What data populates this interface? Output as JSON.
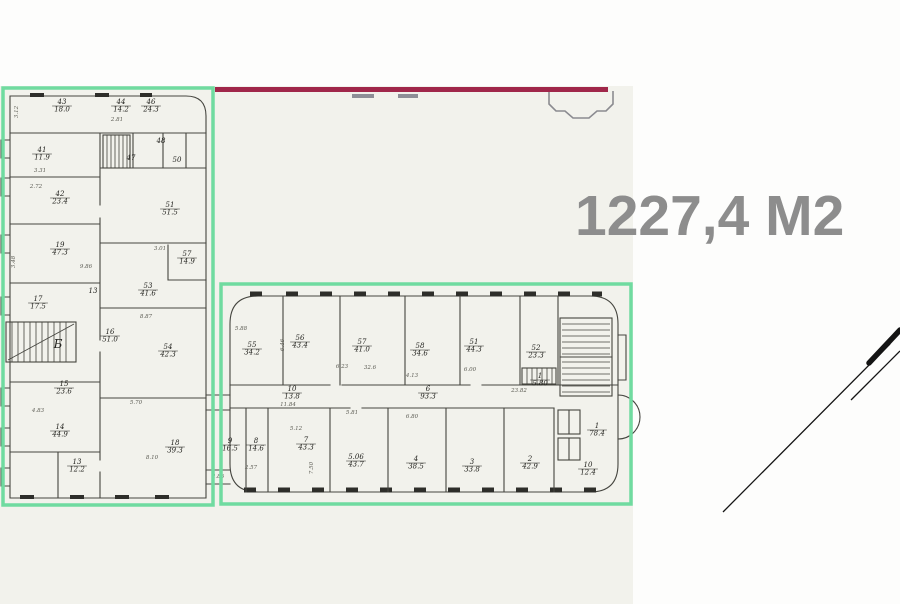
{
  "document": {
    "kind": "scanned floor plan with highlighted zones"
  },
  "area_label": {
    "text": "1227,4 М2"
  },
  "colors": {
    "highlight_green": "#70dba0",
    "line_red": "#a0274a",
    "plan_ink": "#45453f",
    "paper": "#f2f2ec",
    "area_text_gray": "#8d8d8d"
  },
  "plan": {
    "rooms": [
      {
        "num": "43",
        "area": "18.0",
        "x": 62,
        "y": 104
      },
      {
        "num": "44",
        "area": "14.2",
        "x": 121,
        "y": 104
      },
      {
        "num": "46",
        "area": "24.3",
        "x": 151,
        "y": 104
      },
      {
        "num": "48",
        "x": 161,
        "y": 143
      },
      {
        "num": "47",
        "x": 131,
        "y": 160
      },
      {
        "num": "50",
        "x": 177,
        "y": 162
      },
      {
        "num": "41",
        "area": "11.9",
        "x": 42,
        "y": 152
      },
      {
        "num": "42",
        "area": "23.4",
        "x": 60,
        "y": 196
      },
      {
        "num": "51",
        "area": "51.5",
        "x": 170,
        "y": 207
      },
      {
        "num": "19",
        "area": "47.3",
        "x": 60,
        "y": 247
      },
      {
        "num": "57",
        "area": "14.9",
        "x": 187,
        "y": 256
      },
      {
        "num": "53",
        "area": "41.6",
        "x": 148,
        "y": 288
      },
      {
        "num": "13",
        "x": 93,
        "y": 293
      },
      {
        "num": "17",
        "area": "17.5",
        "x": 38,
        "y": 301
      },
      {
        "num": "Б",
        "x": 58,
        "y": 348,
        "big": true
      },
      {
        "num": "16",
        "area": "51.0",
        "x": 110,
        "y": 334
      },
      {
        "num": "15",
        "area": "23.6",
        "x": 64,
        "y": 386
      },
      {
        "num": "54",
        "area": "42.3",
        "x": 168,
        "y": 349
      },
      {
        "num": "14",
        "area": "44.9",
        "x": 60,
        "y": 429
      },
      {
        "num": "18",
        "area": "39.3",
        "x": 175,
        "y": 445
      },
      {
        "num": "13",
        "area": "12.2",
        "x": 77,
        "y": 464
      },
      {
        "num": "55",
        "area": "34.2",
        "x": 252,
        "y": 347
      },
      {
        "num": "56",
        "area": "43.4",
        "x": 300,
        "y": 340
      },
      {
        "num": "57",
        "area": "41.0",
        "x": 362,
        "y": 344
      },
      {
        "num": "58",
        "area": "34.6",
        "x": 420,
        "y": 348
      },
      {
        "num": "51",
        "area": "44.3",
        "x": 474,
        "y": 344
      },
      {
        "num": "52",
        "area": "23.3",
        "x": 536,
        "y": 350
      },
      {
        "num": "1",
        "area": "5.80",
        "x": 540,
        "y": 378
      },
      {
        "num": "6",
        "area": "93.3",
        "x": 428,
        "y": 391
      },
      {
        "num": "10",
        "area": "13.8",
        "x": 292,
        "y": 391
      },
      {
        "num": "9",
        "area": "16.5",
        "x": 230,
        "y": 443
      },
      {
        "num": "8",
        "area": "14.6",
        "x": 256,
        "y": 443
      },
      {
        "num": "7",
        "area": "43.3",
        "x": 306,
        "y": 442
      },
      {
        "num": "5.06",
        "area": "43.7",
        "x": 356,
        "y": 459
      },
      {
        "num": "4",
        "area": "38.5",
        "x": 416,
        "y": 461
      },
      {
        "num": "3",
        "area": "33.8",
        "x": 472,
        "y": 464
      },
      {
        "num": "2",
        "area": "42.9",
        "x": 530,
        "y": 461
      },
      {
        "num": "1",
        "area": "78.4",
        "x": 597,
        "y": 428
      },
      {
        "num": "10",
        "area": "12.4",
        "x": 588,
        "y": 467
      }
    ],
    "dims": [
      {
        "t": "3.12",
        "x": 18,
        "y": 112,
        "r": -90
      },
      {
        "t": "2.81",
        "x": 117,
        "y": 121
      },
      {
        "t": "3.31",
        "x": 40,
        "y": 172
      },
      {
        "t": "2.72",
        "x": 36,
        "y": 188
      },
      {
        "t": "3.01",
        "x": 160,
        "y": 250
      },
      {
        "t": "9.86",
        "x": 86,
        "y": 268
      },
      {
        "t": "8.87",
        "x": 146,
        "y": 318
      },
      {
        "t": "3.48",
        "x": 15,
        "y": 262,
        "r": -90
      },
      {
        "t": "5.70",
        "x": 136,
        "y": 404
      },
      {
        "t": "8.10",
        "x": 152,
        "y": 459
      },
      {
        "t": "4.83",
        "x": 38,
        "y": 412
      },
      {
        "t": "5.88",
        "x": 241,
        "y": 330
      },
      {
        "t": "6.46",
        "x": 284,
        "y": 345,
        "r": -90
      },
      {
        "t": "6.23",
        "x": 342,
        "y": 368
      },
      {
        "t": "32.6",
        "x": 370,
        "y": 369
      },
      {
        "t": "4.13",
        "x": 412,
        "y": 377
      },
      {
        "t": "6.00",
        "x": 470,
        "y": 371
      },
      {
        "t": "23.82",
        "x": 519,
        "y": 392
      },
      {
        "t": "11.84",
        "x": 288,
        "y": 406
      },
      {
        "t": "5.81",
        "x": 352,
        "y": 414
      },
      {
        "t": "6.80",
        "x": 412,
        "y": 418
      },
      {
        "t": "5.12",
        "x": 296,
        "y": 430
      },
      {
        "t": "2.57",
        "x": 251,
        "y": 469
      },
      {
        "t": "7.50",
        "x": 313,
        "y": 468,
        "r": -90
      },
      {
        "t": "2.86",
        "x": 218,
        "y": 478
      }
    ]
  }
}
